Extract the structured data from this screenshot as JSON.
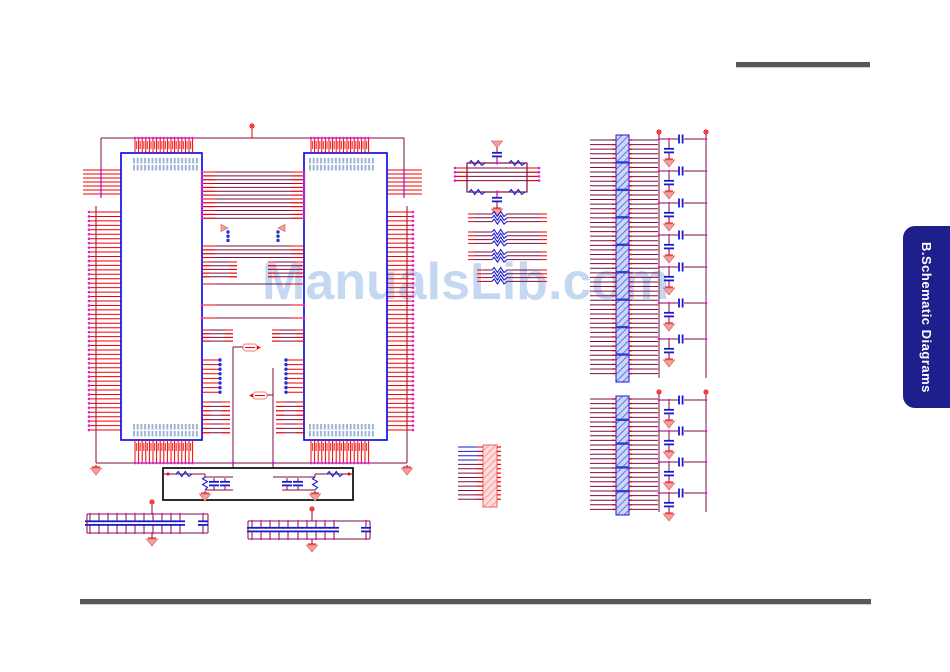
{
  "watermark": {
    "text": "ManualsLib.com",
    "color": "#c5d8f2",
    "x": 262,
    "y": 256,
    "font_size": 52
  },
  "side_tab": {
    "label": "B.Schematic Diagrams",
    "bg": "#1e1e8c",
    "color": "#ffffff",
    "x": 903,
    "y": 226,
    "width": 47,
    "height": 182,
    "radius": 12,
    "font_size": 13
  },
  "rules": {
    "color": "#58585a",
    "top": {
      "x": 736,
      "y": 62,
      "w": 134,
      "h": 5
    },
    "bottom": {
      "x": 80,
      "y": 599,
      "w": 791,
      "h": 5
    }
  },
  "colors": {
    "pin": "#f00000",
    "wire": "#7d0d3c",
    "component": "#1a1acc",
    "outline": "#0000ee",
    "junction": "#e020d0",
    "bluedot": "#2030d8",
    "gndfill": "#f2a2a2",
    "gndstroke": "#e06868",
    "label": "#9fb6d6",
    "black": "#151515",
    "hatchB_bg": "#ccd6f8",
    "hatchB_ln": "#4a5ae0",
    "hatchR_bg": "#ffdcdc",
    "hatchR_ln": "#ff8484"
  },
  "schematic": {
    "width": 950,
    "height": 672,
    "ops": [
      {
        "t": "hline",
        "x1": 101,
        "x2": 404,
        "y": 138
      },
      {
        "t": "vline",
        "x": 252,
        "y1": 128,
        "y2": 138,
        "c": "pin"
      },
      {
        "t": "pwr",
        "x": 252,
        "y": 126
      },
      {
        "t": "vline",
        "x": 101,
        "y1": 138,
        "y2": 198
      },
      {
        "t": "vline",
        "x": 404,
        "y1": 138,
        "y2": 198
      },
      {
        "t": "hpins",
        "x1": 83,
        "x2": 121,
        "y0": 170,
        "n": 7,
        "dy": 4,
        "dotx": 101
      },
      {
        "t": "hpins",
        "x1": 387,
        "x2": 422,
        "y0": 170,
        "n": 7,
        "dy": 4,
        "dotx": 404
      },
      {
        "t": "vline",
        "x": 96,
        "y1": 206,
        "y2": 463
      },
      {
        "t": "vline",
        "x": 407,
        "y1": 206,
        "y2": 463
      },
      {
        "t": "hpins",
        "x1": 89,
        "x2": 121,
        "y0": 212,
        "n": 50,
        "dy": 4.45,
        "dotx": 89
      },
      {
        "t": "hpins",
        "x1": 387,
        "x2": 413,
        "y0": 212,
        "n": 50,
        "dy": 4.45,
        "dotx": 413
      },
      {
        "t": "hline",
        "x1": 96,
        "x2": 407,
        "y": 463
      },
      {
        "t": "gnd",
        "x": 96,
        "y": 465
      },
      {
        "t": "gnd",
        "x": 407,
        "y": 465
      },
      {
        "t": "rect",
        "x": 121,
        "y": 153,
        "w": 81,
        "h": 287,
        "stroke": "outline",
        "sw": 1.6
      },
      {
        "t": "rect",
        "x": 304,
        "y": 153,
        "w": 83,
        "h": 287,
        "stroke": "outline",
        "sw": 1.6
      },
      {
        "t": "vpins",
        "x0": 135,
        "n": 17,
        "dx": 3.6,
        "y1": 138,
        "y2": 153,
        "doty": 138
      },
      {
        "t": "vpins",
        "x0": 311,
        "n": 17,
        "dx": 3.6,
        "y1": 138,
        "y2": 153,
        "doty": 138
      },
      {
        "t": "rlabels",
        "x": 136,
        "y": 141,
        "n": 16,
        "dx": 3.6
      },
      {
        "t": "rlabels",
        "x": 312,
        "y": 141,
        "n": 16,
        "dx": 3.6
      },
      {
        "t": "labels",
        "x": 133,
        "y": 158,
        "n": 18,
        "dx": 3.7
      },
      {
        "t": "labels",
        "x": 133,
        "y": 165,
        "n": 18,
        "dx": 3.7
      },
      {
        "t": "labels",
        "x": 309,
        "y": 158,
        "n": 18,
        "dx": 3.7
      },
      {
        "t": "labels",
        "x": 309,
        "y": 165,
        "n": 18,
        "dx": 3.7
      },
      {
        "t": "vpins",
        "x0": 135,
        "n": 17,
        "dx": 3.6,
        "y1": 440,
        "y2": 463,
        "doty": 463
      },
      {
        "t": "vpins",
        "x0": 311,
        "n": 17,
        "dx": 3.6,
        "y1": 440,
        "y2": 463,
        "doty": 463
      },
      {
        "t": "labels",
        "x": 133,
        "y": 424,
        "n": 18,
        "dx": 3.7
      },
      {
        "t": "labels",
        "x": 133,
        "y": 431,
        "n": 18,
        "dx": 3.7
      },
      {
        "t": "labels",
        "x": 309,
        "y": 424,
        "n": 18,
        "dx": 3.7
      },
      {
        "t": "labels",
        "x": 309,
        "y": 431,
        "n": 18,
        "dx": 3.7
      },
      {
        "t": "rlabels",
        "x": 136,
        "y": 443,
        "n": 16,
        "dx": 3.6
      },
      {
        "t": "rlabels",
        "x": 312,
        "y": 443,
        "n": 16,
        "dx": 3.6
      },
      {
        "t": "bus",
        "x1": 202,
        "x2": 304,
        "y0": 172,
        "n": 13,
        "dy": 3.85,
        "end": 13,
        "dots": true
      },
      {
        "t": "arrow",
        "x": 221,
        "y": 228,
        "dir": 1
      },
      {
        "t": "arrow",
        "x": 285,
        "y": 228,
        "dir": -1
      },
      {
        "t": "bdots",
        "x": 228,
        "y0": 232,
        "n": 3,
        "dy": 4.2
      },
      {
        "t": "bdots",
        "x": 278,
        "y0": 232,
        "n": 3,
        "dy": 4.2
      },
      {
        "t": "bus",
        "x1": 202,
        "x2": 304,
        "y0": 246,
        "n": 4,
        "dy": 3.85,
        "end": 13
      },
      {
        "t": "bus",
        "x1": 202,
        "x2": 237,
        "y0": 262,
        "n": 5,
        "dy": 3.7,
        "end": 8
      },
      {
        "t": "bus",
        "x1": 268,
        "x2": 304,
        "y0": 262,
        "n": 5,
        "dy": 3.7,
        "end": 8
      },
      {
        "t": "bus",
        "x1": 202,
        "x2": 304,
        "y0": 284,
        "n": 1,
        "dy": 4,
        "end": 13
      },
      {
        "t": "bus",
        "x1": 202,
        "x2": 304,
        "y0": 305,
        "n": 1,
        "dy": 4,
        "end": 13,
        "dots": true
      },
      {
        "t": "bus",
        "x1": 202,
        "x2": 304,
        "y0": 318,
        "n": 1,
        "dy": 4,
        "end": 13,
        "dots": true
      },
      {
        "t": "bus",
        "x1": 202,
        "x2": 233,
        "y0": 330,
        "n": 4,
        "dy": 3.7,
        "end": 8
      },
      {
        "t": "bus",
        "x1": 272,
        "x2": 304,
        "y0": 330,
        "n": 4,
        "dy": 3.7,
        "end": 8
      },
      {
        "t": "jumper",
        "x": 243,
        "y": 344,
        "dir": 1
      },
      {
        "t": "hline",
        "x1": 233,
        "x2": 243,
        "y": 347
      },
      {
        "t": "vline",
        "x": 233,
        "y1": 347,
        "y2": 468
      },
      {
        "t": "dot",
        "x": 233,
        "y": 463
      },
      {
        "t": "dotstubs",
        "x1": 202,
        "x2": 220,
        "y0": 360,
        "n": 8,
        "dy": 4.6
      },
      {
        "t": "dotstubs",
        "x1": 304,
        "x2": 286,
        "y0": 360,
        "n": 8,
        "dy": 4.6
      },
      {
        "t": "vline",
        "x": 273,
        "y1": 368,
        "y2": 468
      },
      {
        "t": "dot",
        "x": 273,
        "y": 463
      },
      {
        "t": "jumper",
        "x": 253,
        "y": 392,
        "dir": -1
      },
      {
        "t": "hline",
        "x1": 267,
        "x2": 273,
        "y": 395
      },
      {
        "t": "bus",
        "x1": 202,
        "x2": 230,
        "y0": 402,
        "n": 8,
        "dy": 4.4,
        "end": 8
      },
      {
        "t": "bus",
        "x1": 276,
        "x2": 304,
        "y0": 402,
        "n": 8,
        "dy": 4.4,
        "end": 8
      },
      {
        "t": "rect",
        "x": 163,
        "y": 468,
        "w": 190,
        "h": 32,
        "stroke": "black",
        "sw": 1.8
      },
      {
        "t": "hline",
        "x1": 163,
        "x2": 205,
        "y": 474
      },
      {
        "t": "dot",
        "x": 168,
        "y": 474,
        "c": "pin"
      },
      {
        "t": "resh",
        "x": 176,
        "y": 474,
        "len": 16
      },
      {
        "t": "vline",
        "x": 205,
        "y1": 474,
        "y2": 477
      },
      {
        "t": "hline",
        "x1": 205,
        "x2": 233,
        "y": 477
      },
      {
        "t": "hline",
        "x1": 205,
        "x2": 233,
        "y": 490
      },
      {
        "t": "resv",
        "x": 205,
        "y": 477,
        "len": 13
      },
      {
        "t": "capv",
        "x": 214,
        "y": 478,
        "h": 12
      },
      {
        "t": "capv",
        "x": 225,
        "y": 478,
        "h": 12
      },
      {
        "t": "gnd",
        "x": 205,
        "y": 491
      },
      {
        "t": "hline",
        "x1": 315,
        "x2": 353,
        "y": 474
      },
      {
        "t": "dot",
        "x": 349,
        "y": 474,
        "c": "pin"
      },
      {
        "t": "resh",
        "x": 327,
        "y": 474,
        "len": 16
      },
      {
        "t": "vline",
        "x": 315,
        "y1": 474,
        "y2": 477
      },
      {
        "t": "hline",
        "x1": 273,
        "x2": 315,
        "y": 477
      },
      {
        "t": "hline",
        "x1": 282,
        "x2": 315,
        "y": 490
      },
      {
        "t": "resv",
        "x": 315,
        "y": 477,
        "len": 13
      },
      {
        "t": "capv",
        "x": 287,
        "y": 478,
        "h": 12
      },
      {
        "t": "capv",
        "x": 298,
        "y": 478,
        "h": 12
      },
      {
        "t": "gnd",
        "x": 315,
        "y": 491
      },
      {
        "t": "capbank",
        "x1": 87,
        "x2": 208,
        "ytop": 514,
        "ybot": 533,
        "caps": [
          90,
          99,
          108,
          117,
          126,
          135,
          144,
          153,
          162,
          171,
          180
        ],
        "far": 203,
        "px": 152
      },
      {
        "t": "capbank",
        "x1": 248,
        "x2": 370,
        "ytop": 521,
        "ybot": 539,
        "caps": [
          252,
          261,
          270,
          279,
          288,
          298,
          307,
          316,
          325,
          334
        ],
        "far": 366,
        "px": 312
      },
      {
        "t": "rect",
        "x": 467,
        "y": 163,
        "w": 60,
        "h": 29,
        "stroke": "wire",
        "sw": 1.2
      },
      {
        "t": "resh",
        "x": 469,
        "y": 163,
        "len": 16
      },
      {
        "t": "resh",
        "x": 509,
        "y": 163,
        "len": 16
      },
      {
        "t": "resh",
        "x": 469,
        "y": 192,
        "len": 16
      },
      {
        "t": "resh",
        "x": 509,
        "y": 192,
        "len": 16
      },
      {
        "t": "gndup",
        "x": 497,
        "y": 141
      },
      {
        "t": "capv",
        "x": 497,
        "y": 149,
        "h": 12
      },
      {
        "t": "vline",
        "x": 497,
        "y1": 161,
        "y2": 163
      },
      {
        "t": "dot",
        "x": 497,
        "y": 163
      },
      {
        "t": "vline",
        "x": 497,
        "y1": 192,
        "y2": 194
      },
      {
        "t": "capv",
        "x": 497,
        "y": 194,
        "h": 12
      },
      {
        "t": "gnd",
        "x": 497,
        "y": 206
      },
      {
        "t": "dot",
        "x": 497,
        "y": 192
      },
      {
        "t": "bus",
        "x1": 455,
        "x2": 539,
        "y0": 168,
        "n": 4,
        "dy": 4.2,
        "end": 12,
        "dots": true
      },
      {
        "t": "rbus",
        "x1": 468,
        "x2": 547,
        "rx": 492,
        "y0": 214,
        "n": 3,
        "dy": 3.8
      },
      {
        "t": "rbus",
        "x1": 468,
        "x2": 547,
        "rx": 492,
        "y0": 232,
        "n": 4,
        "dy": 3.8
      },
      {
        "t": "rbus",
        "x1": 468,
        "x2": 547,
        "rx": 492,
        "y0": 252,
        "n": 3,
        "dy": 3.8
      },
      {
        "t": "rbus",
        "x1": 477,
        "x2": 547,
        "rx": 492,
        "y0": 270,
        "n": 4,
        "dy": 3.8
      },
      {
        "t": "strip",
        "x": 483,
        "y": 445,
        "w": 14,
        "h": 62,
        "kind": "red"
      },
      {
        "t": "mlines",
        "x1": 458,
        "x2": 483,
        "y0": 447,
        "n": 13,
        "dy": 4.35,
        "blue_n": 4,
        "tickx": 497,
        "tickw": 4
      },
      {
        "t": "bus",
        "x1": 590,
        "x2": 658,
        "y0": 140,
        "n": 52,
        "dy": 4.58,
        "end": 0,
        "ticks": [
          612,
          629
        ]
      },
      {
        "t": "strip",
        "x": 616,
        "y": 135,
        "w": 13,
        "h": 247,
        "kind": "blue",
        "bands": 8
      },
      {
        "t": "vline",
        "x": 659,
        "y1": 134,
        "y2": 378
      },
      {
        "t": "vline",
        "x": 706,
        "y1": 134,
        "y2": 378
      },
      {
        "t": "pwr",
        "x": 659,
        "y": 132
      },
      {
        "t": "pwr",
        "x": 706,
        "y": 132
      },
      {
        "t": "cluster",
        "y": 139
      },
      {
        "t": "cluster",
        "y": 171
      },
      {
        "t": "cluster",
        "y": 203
      },
      {
        "t": "cluster",
        "y": 235
      },
      {
        "t": "cluster",
        "y": 267
      },
      {
        "t": "cluster",
        "y": 303
      },
      {
        "t": "cluster",
        "y": 339
      },
      {
        "t": "bus",
        "x1": 590,
        "x2": 658,
        "y0": 399,
        "n": 25,
        "dy": 4.6,
        "end": 0,
        "ticks": [
          612,
          629
        ]
      },
      {
        "t": "strip",
        "x": 616,
        "y": 396,
        "w": 13,
        "h": 119,
        "kind": "blue",
        "bands": 4
      },
      {
        "t": "vline",
        "x": 659,
        "y1": 394,
        "y2": 512
      },
      {
        "t": "vline",
        "x": 706,
        "y1": 394,
        "y2": 512
      },
      {
        "t": "pwr",
        "x": 659,
        "y": 392
      },
      {
        "t": "pwr",
        "x": 706,
        "y": 392
      },
      {
        "t": "cluster",
        "y": 400
      },
      {
        "t": "cluster",
        "y": 431
      },
      {
        "t": "cluster",
        "y": 462
      },
      {
        "t": "cluster",
        "y": 493
      }
    ]
  }
}
